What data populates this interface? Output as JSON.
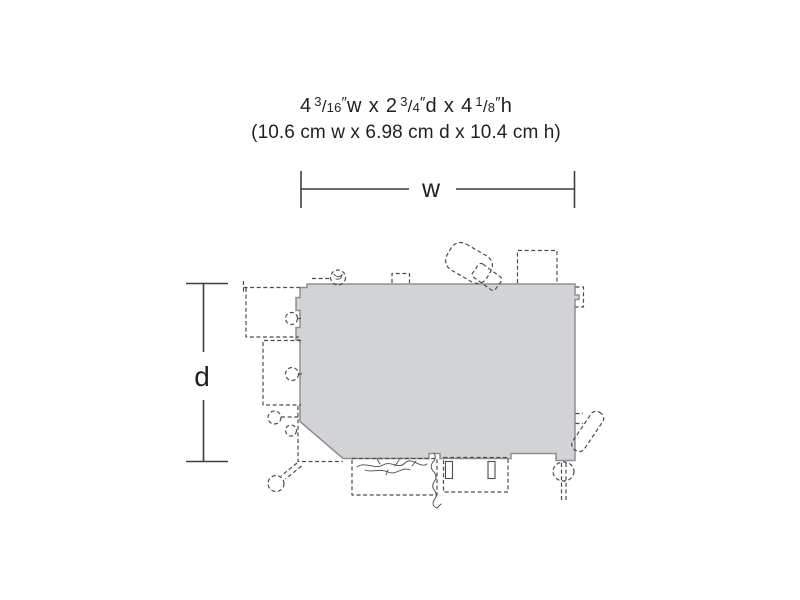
{
  "header": {
    "imperial": {
      "dim_w": {
        "whole": "4",
        "num": "3",
        "den": "16",
        "unit": "w"
      },
      "dim_d": {
        "whole": "2",
        "num": "3",
        "den": "4",
        "unit": "d"
      },
      "dim_h": {
        "whole": "4",
        "num": "1",
        "den": "8",
        "unit": "h"
      },
      "inch_mark": "″",
      "fraction_slash": "/",
      "separator": "x"
    },
    "metric": "(10.6 cm w x 6.98 cm d x 10.4 cm h)"
  },
  "dimension_labels": {
    "width": "w",
    "depth": "d"
  },
  "colors": {
    "background": "#ffffff",
    "footprint_fill": "#d2d3d5",
    "footprint_stroke": "#8f9094",
    "detail_dash": "#4c4c4e",
    "dimension_line": "#3e3e40",
    "text": "#231f20"
  }
}
